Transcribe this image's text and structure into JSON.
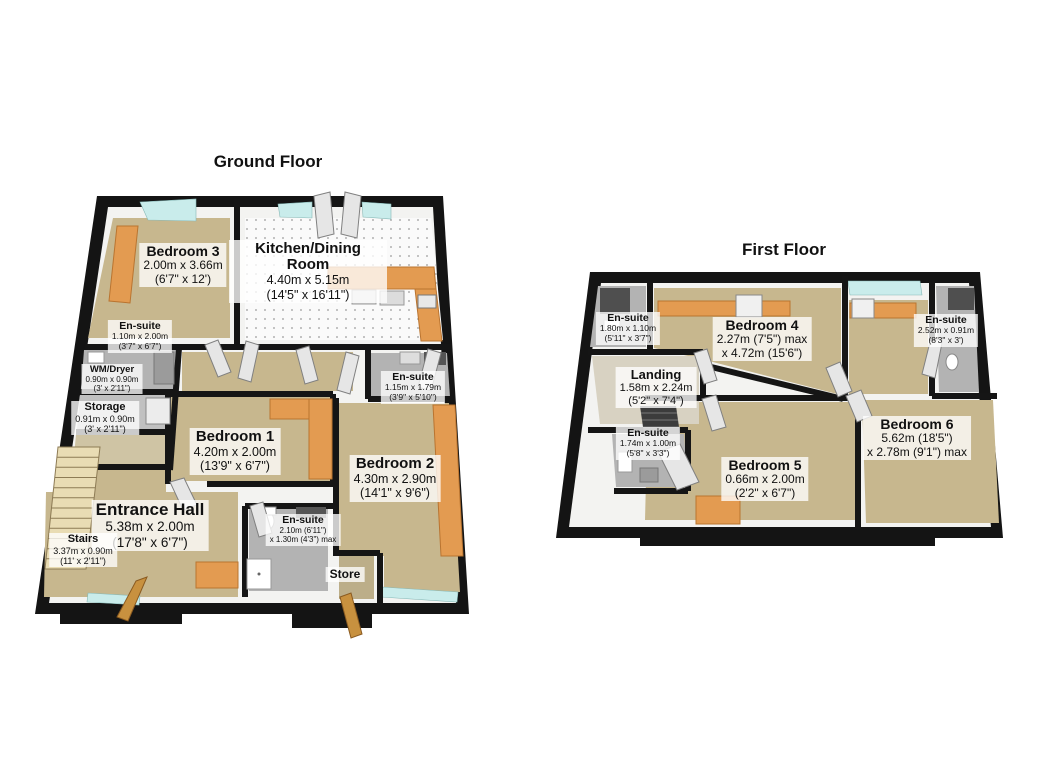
{
  "image_type": "3D floor plan, two plans on white background",
  "colors": {
    "background": "#ffffff",
    "outer_wall": "#141414",
    "inner_wall_face": "#f3f3f1",
    "carpet_tan": "#c7b78e",
    "carpet_dark": "#bcae89",
    "kitchen_floor": "#fafafa",
    "ensuite_floor": "#b3b3b3",
    "landing_floor": "#d8d2c2",
    "furniture_orange": "#e39b51",
    "window_glass": "#c9eceb",
    "stairs_beige": "#e9dcb4",
    "door_leaf": "#e6e6e6",
    "wood_door": "#c8913f",
    "label_background": "rgba(255,255,255,0.78)"
  },
  "floors": [
    {
      "title": "Ground Floor",
      "rooms": [
        {
          "key": "bedroom-3",
          "name": "Bedroom 3",
          "line1": "2.00m x 3.66m",
          "line2": "(6'7\" x 12')"
        },
        {
          "key": "kitchen-dining-room",
          "name": "Kitchen/Dining Room",
          "line1": "4.40m x 5.15m",
          "line2": "(14'5\" x 16'11\")"
        },
        {
          "key": "ensuite-left",
          "name": "En-suite",
          "line1": "1.10m x 2.00m",
          "line2": "(3'7\" x 6'7\")"
        },
        {
          "key": "wm-dryer",
          "name": "WM/Dryer",
          "line1": "0.90m x 0.90m",
          "line2": "(3' x 2'11\")"
        },
        {
          "key": "storage",
          "name": "Storage",
          "line1": "0.91m x 0.90m",
          "line2": "(3' x 2'11\")"
        },
        {
          "key": "bedroom-1",
          "name": "Bedroom 1",
          "line1": "4.20m x 2.00m",
          "line2": "(13'9\" x 6'7\")"
        },
        {
          "key": "ensuite-right",
          "name": "En-suite",
          "line1": "1.15m x 1.79m",
          "line2": "(3'9\" x 5'10\")"
        },
        {
          "key": "bedroom-2",
          "name": "Bedroom 2",
          "line1": "4.30m x 2.90m",
          "line2": "(14'1\" x 9'6\")"
        },
        {
          "key": "entrance-hall",
          "name": "Entrance Hall",
          "line1": "5.38m x 2.00m",
          "line2": "(17'8\" x 6'7\")"
        },
        {
          "key": "stairs",
          "name": "Stairs",
          "line1": "3.37m x 0.90m",
          "line2": "(11' x 2'11\")"
        },
        {
          "key": "ensuite-bottom",
          "name": "En-suite",
          "line1": "2.10m (6'11\")",
          "line2": "x 1.30m (4'3\") max"
        },
        {
          "key": "store",
          "name": "Store",
          "line1": "",
          "line2": ""
        }
      ]
    },
    {
      "title": "First Floor",
      "rooms": [
        {
          "key": "ensuite-top-left",
          "name": "En-suite",
          "line1": "1.80m x 1.10m",
          "line2": "(5'11\" x 3'7\")"
        },
        {
          "key": "bedroom-4",
          "name": "Bedroom 4",
          "line1": "2.27m (7'5\") max",
          "line2": "x 4.72m (15'6\")"
        },
        {
          "key": "ensuite-top-right",
          "name": "En-suite",
          "line1": "2.52m x 0.91m",
          "line2": "(8'3\" x 3')"
        },
        {
          "key": "landing",
          "name": "Landing",
          "line1": "1.58m x 2.24m",
          "line2": "(5'2\" x 7'4\")"
        },
        {
          "key": "ensuite-bottom-left",
          "name": "En-suite",
          "line1": "1.74m x 1.00m",
          "line2": "(5'8\" x 3'3\")"
        },
        {
          "key": "bedroom-5",
          "name": "Bedroom 5",
          "line1": "0.66m x 2.00m",
          "line2": "(2'2\" x 6'7\")"
        },
        {
          "key": "bedroom-6",
          "name": "Bedroom 6",
          "line1": "5.62m (18'5\")",
          "line2": "x 2.78m (9'1\") max"
        }
      ]
    }
  ]
}
